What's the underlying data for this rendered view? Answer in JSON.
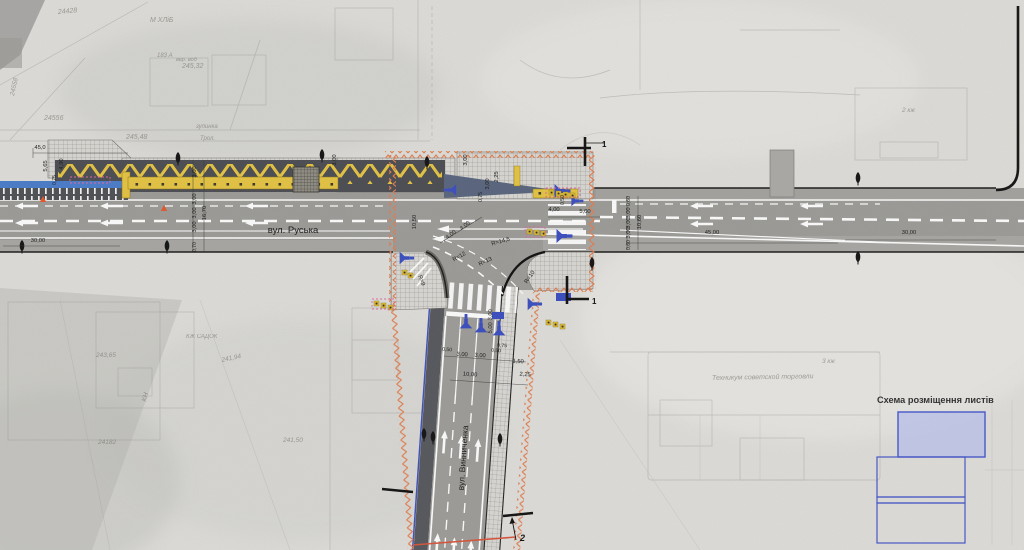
{
  "streets": {
    "main": "вул. Руська",
    "secondary": "вул. Винниченка"
  },
  "legend": {
    "title": "Схема розміщення листів",
    "sheets": [
      "current-sheet",
      "sheet-2",
      "sheet-strip",
      "sheet-3"
    ],
    "current_fill": "#b9c1e8",
    "frame_stroke": "#4456c8"
  },
  "sections": {
    "one": "1",
    "two": "2"
  },
  "colors": {
    "asphalt": "#9b9a96",
    "dark_band": "#4b4d52",
    "median_yellow": "#e2c243",
    "signal_blue": "#3a4dbe",
    "boundary_orange": "#df7b4c",
    "marking_white": "#fafafa",
    "cone_red": "#e0572e"
  },
  "dims": [
    {
      "t": "45,0",
      "x": 40,
      "y": 149
    },
    {
      "t": "5,65",
      "x": 47,
      "y": 166,
      "r": -90
    },
    {
      "t": "4,90",
      "x": 63,
      "y": 164,
      "r": -90
    },
    {
      "t": "0,75",
      "x": 56,
      "y": 180,
      "r": -90,
      "s": 5
    },
    {
      "t": "30,00",
      "x": 38,
      "y": 242
    },
    {
      "t": "3,00",
      "x": 196,
      "y": 172,
      "r": -90
    },
    {
      "t": "16,70",
      "x": 206,
      "y": 213,
      "r": -90
    },
    {
      "t": "3,00",
      "x": 196,
      "y": 199,
      "r": -90
    },
    {
      "t": "3,00",
      "x": 196,
      "y": 213,
      "r": -90
    },
    {
      "t": "3,00",
      "x": 196,
      "y": 227,
      "r": -90
    },
    {
      "t": "0,70",
      "x": 196,
      "y": 247,
      "r": -90,
      "s": 5
    },
    {
      "t": "3,00",
      "x": 336,
      "y": 160,
      "r": -90
    },
    {
      "t": "10,50",
      "x": 416,
      "y": 222,
      "r": -90
    },
    {
      "t": "4,00",
      "x": 452,
      "y": 236,
      "r": -38
    },
    {
      "t": "4,00",
      "x": 466,
      "y": 227,
      "r": -38
    },
    {
      "t": "3,00",
      "x": 467,
      "y": 160,
      "r": -90
    },
    {
      "t": "0,75",
      "x": 482,
      "y": 197,
      "r": -90,
      "s": 5
    },
    {
      "t": "3,00",
      "x": 489,
      "y": 184,
      "r": -90
    },
    {
      "t": "2,25",
      "x": 498,
      "y": 177,
      "r": -90
    },
    {
      "t": "0,50",
      "x": 564,
      "y": 200,
      "r": -90,
      "s": 5
    },
    {
      "t": "4,00",
      "x": 554,
      "y": 211
    },
    {
      "t": "5,00",
      "x": 585,
      "y": 213
    },
    {
      "t": "R=14,5",
      "x": 501,
      "y": 243,
      "r": -15
    },
    {
      "t": "R=12",
      "x": 460,
      "y": 258,
      "r": -30
    },
    {
      "t": "R=13",
      "x": 486,
      "y": 263,
      "r": -25
    },
    {
      "t": "R=9",
      "x": 420,
      "y": 281,
      "r": 70
    },
    {
      "t": "R=10",
      "x": 531,
      "y": 278,
      "r": -55
    },
    {
      "t": "0,60",
      "x": 630,
      "y": 201,
      "r": -90,
      "s": 5
    },
    {
      "t": "3,00",
      "x": 630,
      "y": 213,
      "r": -90
    },
    {
      "t": "3,00",
      "x": 630,
      "y": 223,
      "r": -90
    },
    {
      "t": "3,00",
      "x": 630,
      "y": 233,
      "r": -90
    },
    {
      "t": "0,60",
      "x": 630,
      "y": 245,
      "r": -90,
      "s": 5
    },
    {
      "t": "10,60",
      "x": 641,
      "y": 222,
      "r": -90
    },
    {
      "t": "45,00",
      "x": 712,
      "y": 234
    },
    {
      "t": "30,00",
      "x": 909,
      "y": 234
    },
    {
      "t": "3,00",
      "x": 492,
      "y": 315,
      "r": -86
    },
    {
      "t": "5,00",
      "x": 492,
      "y": 328,
      "r": -86
    },
    {
      "t": "0,50",
      "x": 447,
      "y": 351,
      "r": 4,
      "s": 5
    },
    {
      "t": "3,00",
      "x": 462,
      "y": 356,
      "r": 4
    },
    {
      "t": "3,00",
      "x": 480,
      "y": 357,
      "r": 4
    },
    {
      "t": "0,50",
      "x": 496,
      "y": 352,
      "r": 4,
      "s": 5
    },
    {
      "t": "0,75",
      "x": 502,
      "y": 347,
      "r": 4,
      "s": 5
    },
    {
      "t": "1,50",
      "x": 518,
      "y": 363,
      "r": 4
    },
    {
      "t": "10,00",
      "x": 470,
      "y": 376,
      "r": 4
    },
    {
      "t": "2,25",
      "x": 525,
      "y": 376,
      "r": 4
    }
  ],
  "scan_labels": [
    {
      "t": "М ХЛіБ",
      "x": 150,
      "y": 22,
      "s": 7
    },
    {
      "t": "24428",
      "x": 58,
      "y": 14,
      "r": -5,
      "s": 7
    },
    {
      "t": "245,32",
      "x": 182,
      "y": 68,
      "s": 7
    },
    {
      "t": "183 А",
      "x": 157,
      "y": 57,
      "s": 6
    },
    {
      "t": "вер. вод",
      "x": 176,
      "y": 61,
      "s": 5.5
    },
    {
      "t": "24558",
      "x": 14,
      "y": 96,
      "r": -78,
      "s": 6.5
    },
    {
      "t": "24556",
      "x": 44,
      "y": 120,
      "s": 7
    },
    {
      "t": "245,48",
      "x": 126,
      "y": 139,
      "s": 7
    },
    {
      "t": "зупинка",
      "x": 196,
      "y": 128,
      "s": 6
    },
    {
      "t": "Трол.",
      "x": 200,
      "y": 140,
      "s": 6
    },
    {
      "t": "КН",
      "x": 146,
      "y": 402,
      "r": -75,
      "s": 7
    },
    {
      "t": "КЖ САДОК",
      "x": 186,
      "y": 338,
      "s": 6
    },
    {
      "t": "243,65",
      "x": 96,
      "y": 357,
      "s": 6.5
    },
    {
      "t": "241,94",
      "x": 222,
      "y": 362,
      "r": -12,
      "s": 6.5
    },
    {
      "t": "241,50",
      "x": 283,
      "y": 442,
      "s": 6.5
    },
    {
      "t": "24182",
      "x": 98,
      "y": 444,
      "s": 6.5
    },
    {
      "t": "Техникум советской торговли",
      "x": 712,
      "y": 380,
      "r": -1,
      "s": 7
    },
    {
      "t": "3 кж",
      "x": 822,
      "y": 363,
      "s": 6.5
    },
    {
      "t": "2 кж",
      "x": 902,
      "y": 112,
      "s": 6.5
    },
    {
      "t": "вул. Руська",
      "x": 600,
      "y": 228,
      "s": 7.5
    }
  ]
}
